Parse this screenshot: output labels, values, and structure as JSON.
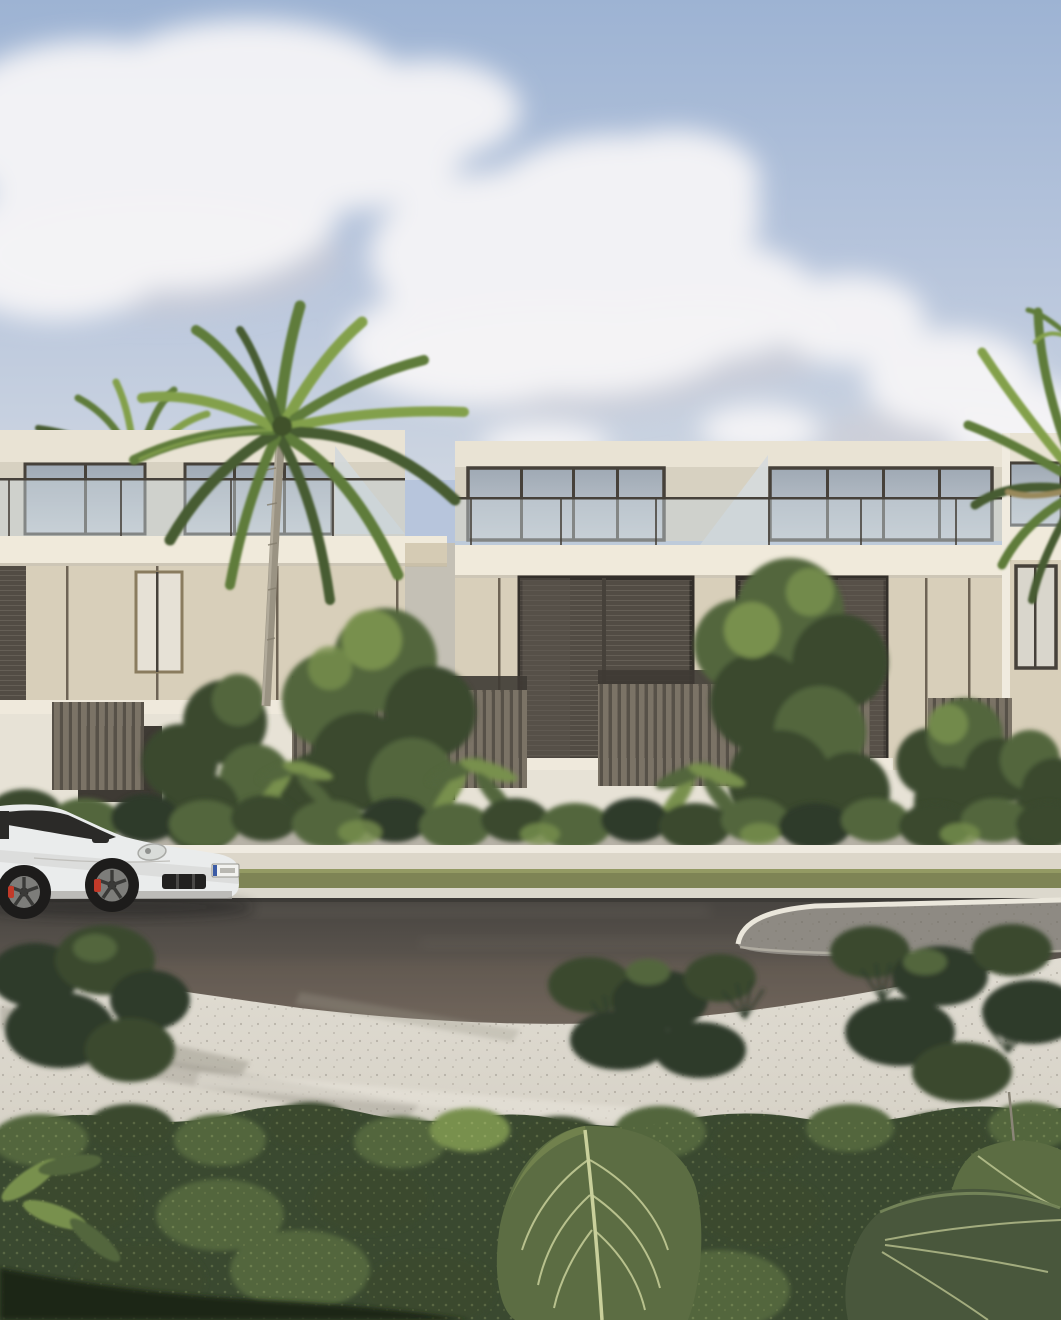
{
  "scene": {
    "type": "architectural-exterior-rendering",
    "subject": "modern two-storey townhouses with roof terraces, tropical landscaping, street with white sports coupe and traffic island",
    "elements": {
      "sky": "blue sky with cumulus clouds",
      "buildings": "cream stucco townhouses with glass roof balustrades and dark louvered windows",
      "palm_main": "tall coconut palm in front of facade",
      "palm_left": "palm crown behind left roofline",
      "palm_right": "palm fronds at right edge",
      "car": "white sports coupe facing right, dark wheels, red brake calipers",
      "street": "asphalt road with white curbs and paved traffic island",
      "foreground": "dense shrubs with large veined elephant-ear leaves"
    }
  },
  "colors": {
    "sky_top": "#9db3d3",
    "sky_mid": "#b7c5dc",
    "sky_low": "#cdd5e1",
    "cloud": "#f6f5f7",
    "cloud_shadow": "#cfcdd3",
    "parapet": "#e9e3d4",
    "roof_row": "#d7d1c1",
    "roof_glass_a": "#9fa9b4",
    "roof_glass_b": "#c8cfd6",
    "window_frame": "#46413a",
    "balustrade": "#c7d0d7",
    "fascia": "#f0eadb",
    "facade": "#d8cfba",
    "facade_dark": "#c9bda4",
    "seam": "#6e6455",
    "sill": "#efe9dc",
    "ground_wall": "#e7e2d6",
    "ground_window": "#3e3a34",
    "window_glass": "#524c44",
    "fence": "#7b7366",
    "fence_gap": "#575148",
    "planter_wall": "#b7b2a7",
    "street_wall_top": "#efeae0",
    "street_wall": "#dcd6c9",
    "grass": "#7e8455",
    "sidewalk": "#dcd8cd",
    "road_top": "#474440",
    "road_bottom": "#6f655c",
    "island": "#8e8a83",
    "curb": "#eae6db",
    "plaza_top": "#e0dcd2",
    "plaza_bottom": "#ccc7bb",
    "shade": "#9c978c",
    "tree_dark": "#3a4a2f",
    "tree_mid": "#53663c",
    "tree_light": "#78904e",
    "leaf_highlight": "#cdd489",
    "bush": "#2e3b29",
    "foliage_base": "#3a4930",
    "leaf_big": "#5c6d43",
    "leaf_big_dark": "#49573c",
    "leaf_vein": "#c9d09b",
    "car_body": "#eaecec",
    "car_body_shade": "#c2c2bf",
    "car_glass": "#2b2a28",
    "tyre": "#1d1c1b",
    "rim": "#7d7d7a",
    "caliper": "#c23a29",
    "palm_trunk": "#9a9383",
    "palm_dark": "#465c30",
    "palm_mid": "#5f7c3a",
    "palm_light": "#83a04b",
    "palm_dry": "#99895c"
  }
}
